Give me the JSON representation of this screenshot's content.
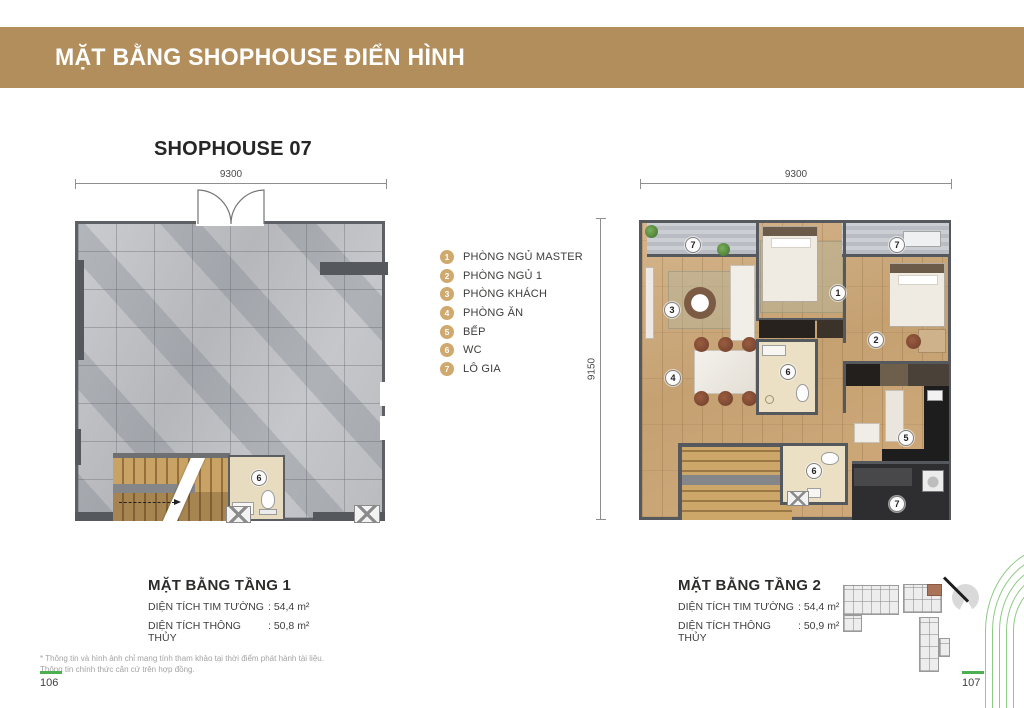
{
  "banner": {
    "title": "MẶT BẰNG SHOPHOUSE ĐIỂN HÌNH"
  },
  "shophouse": {
    "title": "SHOPHOUSE 07"
  },
  "legend": {
    "items": [
      {
        "num": "1",
        "label": "PHÒNG NGỦ MASTER"
      },
      {
        "num": "2",
        "label": "PHÒNG NGỦ 1"
      },
      {
        "num": "3",
        "label": "PHÒNG KHÁCH"
      },
      {
        "num": "4",
        "label": "PHÒNG ĂN"
      },
      {
        "num": "5",
        "label": "BẾP"
      },
      {
        "num": "6",
        "label": "WC"
      },
      {
        "num": "7",
        "label": "LÔ GIA"
      }
    ]
  },
  "floor1": {
    "dim_width": "9300",
    "badges": [
      "6"
    ],
    "info": {
      "title": "MẶT BẰNG TẦNG 1",
      "rows": [
        {
          "label": "DIỆN TÍCH TIM TƯỜNG",
          "value": ": 54,4 m²"
        },
        {
          "label": "DIỆN TÍCH THÔNG THỦY",
          "value": ": 50,8 m²"
        }
      ]
    }
  },
  "floor2": {
    "dim_width": "9300",
    "dim_height": "9150",
    "badges": [
      "7",
      "1",
      "7",
      "3",
      "2",
      "4",
      "6",
      "5",
      "6",
      "7"
    ],
    "info": {
      "title": "MẶT BẰNG TẦNG 2",
      "rows": [
        {
          "label": "DIỆN TÍCH TIM TƯỜNG",
          "value": ": 54,4 m²"
        },
        {
          "label": "DIỆN TÍCH THÔNG THỦY",
          "value": ": 50,9 m²"
        }
      ]
    }
  },
  "footnote": {
    "line1": "* Thông tin và hình ảnh chỉ mang tính tham khảo tại thời điểm phát hành tài liệu.",
    "line2": "Thông tin chính thức căn cứ trên hợp đồng."
  },
  "pages": {
    "left": "106",
    "right": "107"
  },
  "colors": {
    "banner_bg": "#b18e5c",
    "legend_badge": "#cfa96e",
    "accent_green": "#4caf50",
    "arc_green": "#8fcb85",
    "keyplan_highlight": "#a9745a",
    "wall": "#55585c"
  }
}
